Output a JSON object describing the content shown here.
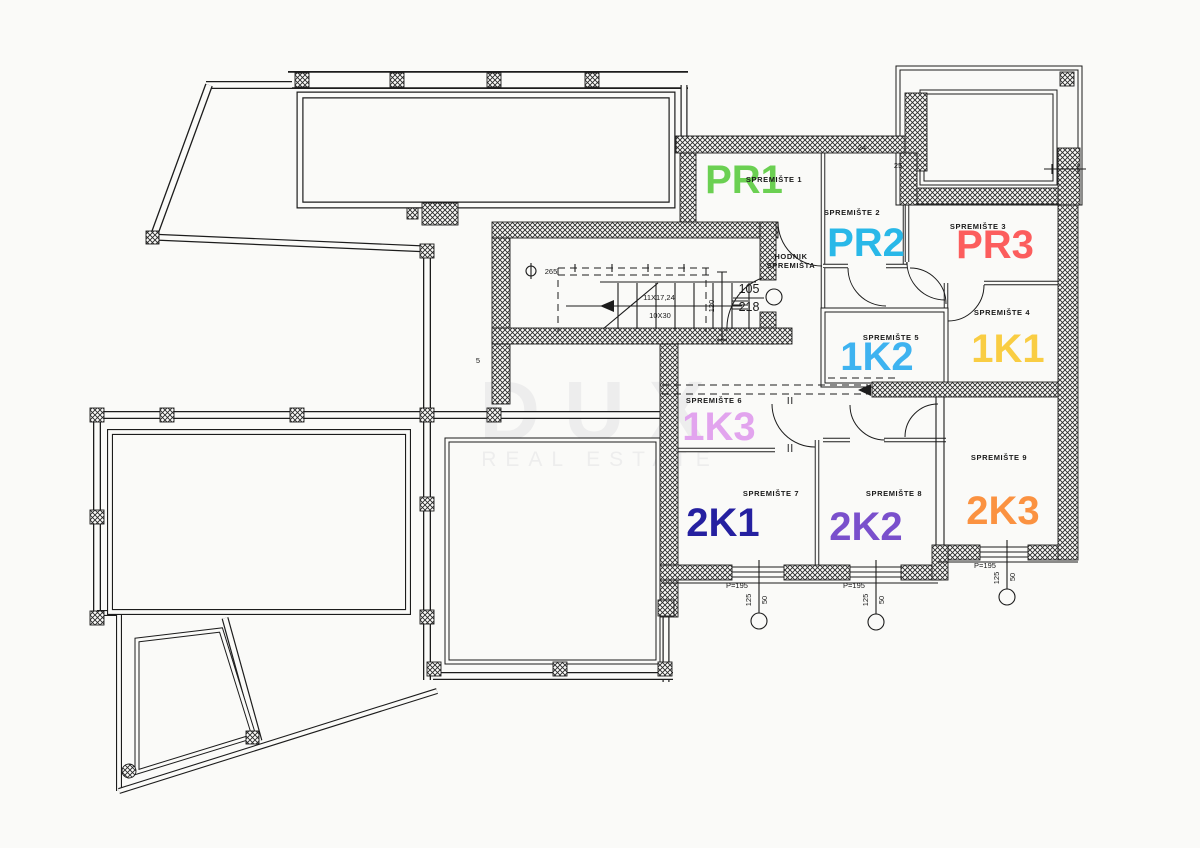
{
  "watermark": {
    "title": "DUX",
    "subtitle": "REAL ESTATE",
    "color": "#ededed"
  },
  "units": [
    {
      "label": "PR1",
      "storage": "SPREMIŠTE 1",
      "color": "#6bd052"
    },
    {
      "label": "PR2",
      "storage": "SPREMIŠTE 2",
      "color": "#29b8e8"
    },
    {
      "label": "PR3",
      "storage": "SPREMIŠTE 3",
      "color": "#fc5d5d"
    },
    {
      "label": "1K1",
      "storage": "SPREMIŠTE 4",
      "color": "#f9cd43"
    },
    {
      "label": "1K2",
      "storage": "SPREMIŠTE 5",
      "color": "#3eb3f0"
    },
    {
      "label": "1K3",
      "storage": "SPREMIŠTE 6",
      "color": "#e2a4ee"
    },
    {
      "label": "2K1",
      "storage": "SPREMIŠTE 7",
      "color": "#2520a0"
    },
    {
      "label": "2K2",
      "storage": "SPREMIŠTE 8",
      "color": "#7a50cc"
    },
    {
      "label": "2K3",
      "storage": "SPREMIŠTE 9",
      "color": "#fb9241"
    }
  ],
  "corridor": {
    "line1": "HODNIK",
    "line2": "SPREMIŠTA"
  },
  "stairs": {
    "rise": "11X17,24",
    "tread": "10X30",
    "spindle": "265",
    "level_upper": "105",
    "level_lower": "218",
    "height": "120"
  },
  "dims": {
    "p195": "P=195",
    "d125": "125",
    "d50": "50",
    "d5": "5",
    "d25": "25",
    "d24": "24"
  }
}
